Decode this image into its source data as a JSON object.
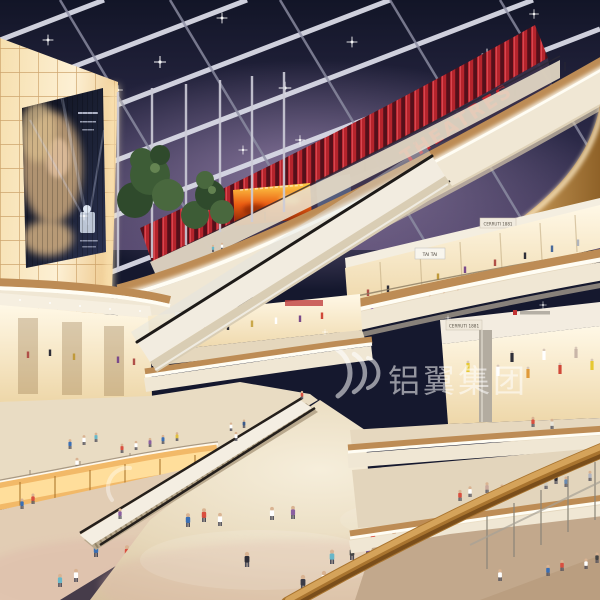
{
  "meta": {
    "type": "architectural-rendering",
    "scene": "Multi-level shopping mall atrium interior at night with glass skylight roof, curved balconies, escalators, backlit advertising wall and crowds of shoppers"
  },
  "signs": {
    "theatres": "THEATRES",
    "tai_tai": "TAI TAI",
    "cerruti_upper": "CERRUTI 1881",
    "cerruti_lower": "CERRUTI 1881",
    "watermark": "铝翼集团"
  },
  "billboard": {
    "description": "Backlit perfume advertisement billboard with woman portrait and perfume bottle on glowing panel wall"
  },
  "palette": {
    "sky": "#15182e",
    "sky_dusk": "#9b86ad",
    "beam": "#d9dae6",
    "theatre_red": "#c32630",
    "slat_red": "#b5242c",
    "wood": "#bd8c55",
    "cream": "#f0e7d4",
    "glow_white": "#fffdf4",
    "amber_glow": "#f2b968",
    "panel_wall": "#f6ddb0",
    "floor": "#e6d8bf",
    "fire_screen": "#ea5c12",
    "watermark_white": "#ffffff"
  }
}
